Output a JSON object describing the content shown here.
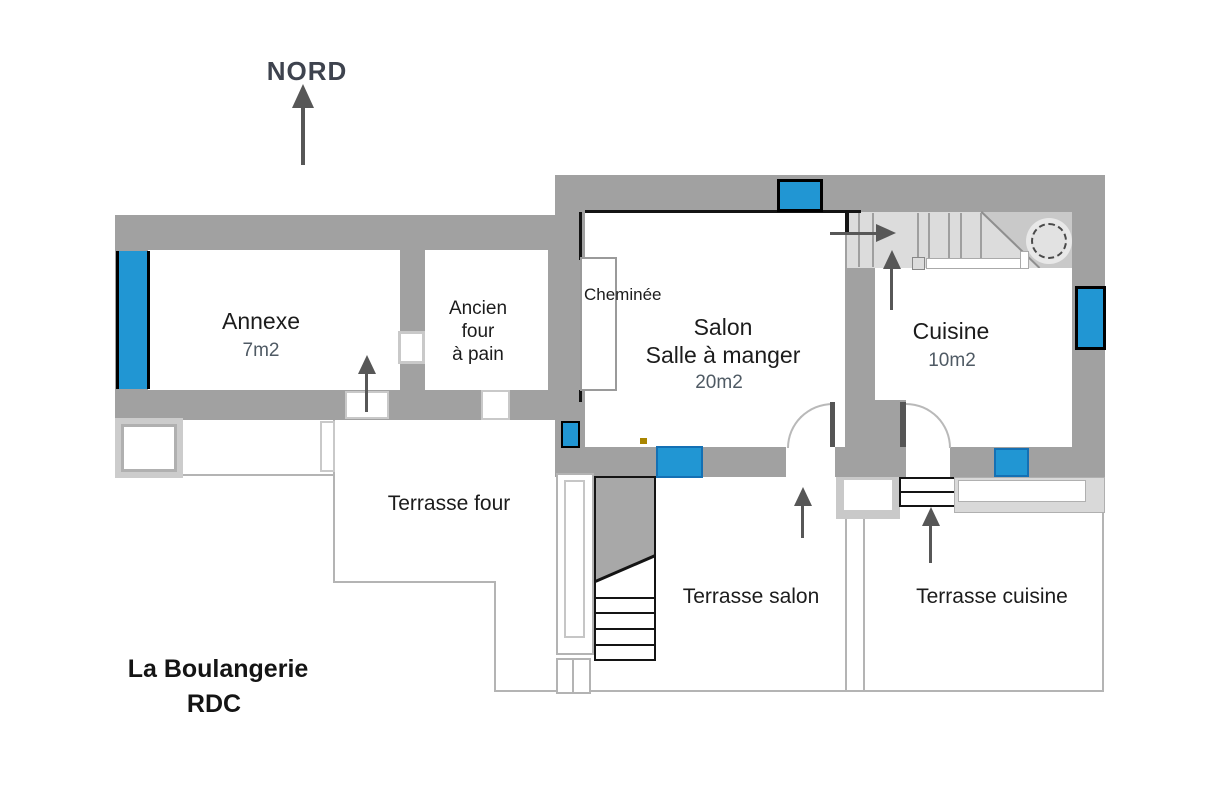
{
  "title": {
    "line1": "La Boulangerie",
    "line2": "RDC"
  },
  "compass": {
    "label": "NORD"
  },
  "rooms": {
    "annexe": {
      "name": "Annexe",
      "area": "7m2"
    },
    "ancien_four": {
      "line1": "Ancien",
      "line2": "four",
      "line3": "à pain"
    },
    "cheminee": {
      "name": "Cheminée"
    },
    "salon": {
      "name": "Salon",
      "subname": "Salle à manger",
      "area": "20m2"
    },
    "cuisine": {
      "name": "Cuisine",
      "area": "10m2"
    }
  },
  "terraces": {
    "four": {
      "name": "Terrasse four"
    },
    "salon": {
      "name": "Terrasse salon"
    },
    "cuisine": {
      "name": "Terrasse cuisine"
    }
  },
  "colors": {
    "wall_gray": "#a1a1a1",
    "stair_gray": "#dcdcdc",
    "window_blue": "#2196d3",
    "arrow_gray": "#575757",
    "area_label_gray": "#4f5a64",
    "outline_black": "#141414"
  }
}
